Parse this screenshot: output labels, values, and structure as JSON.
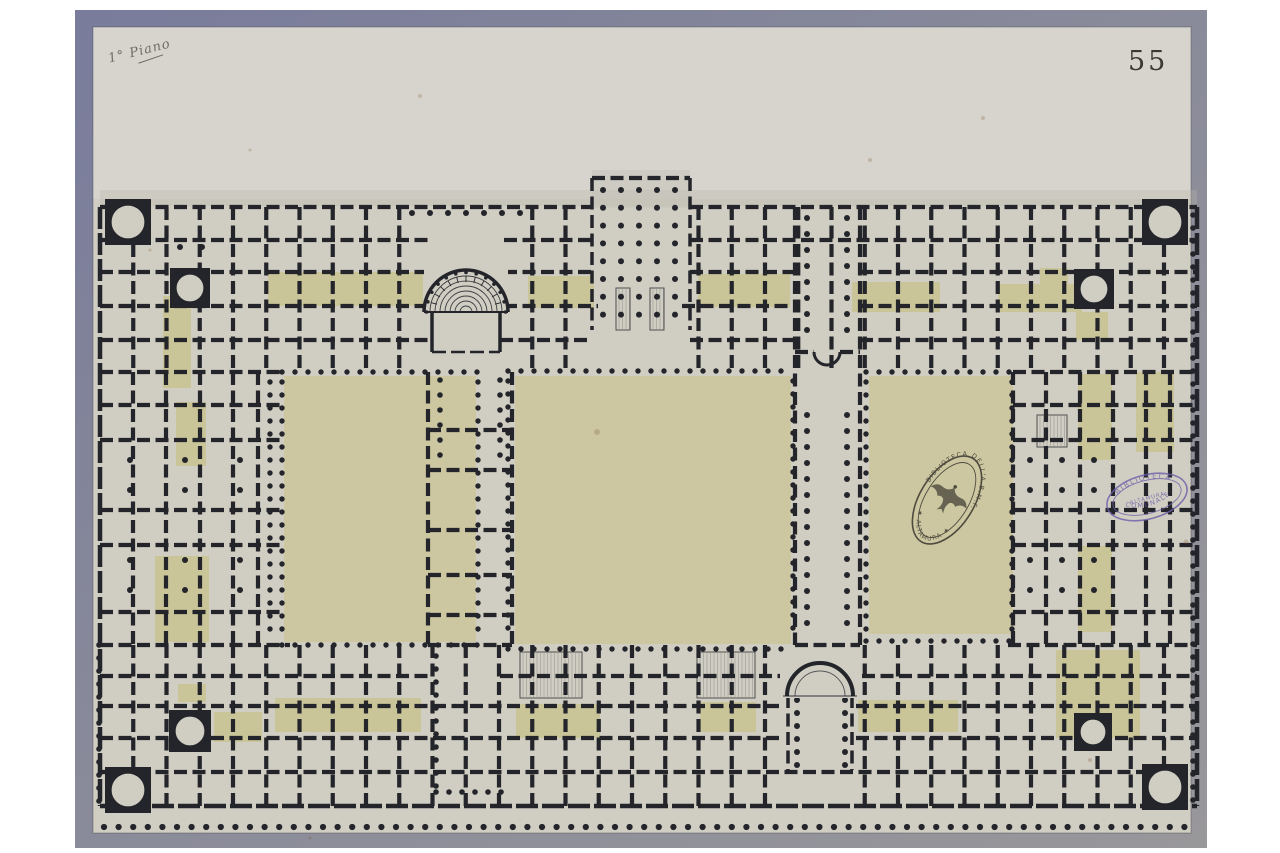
{
  "page": {
    "number": "55",
    "annotation": "1° Piano"
  },
  "stamps": {
    "ink_oval": {
      "top_text": "BIBLIOTECA DELL'A.B.M.F.",
      "bottom_text": "★ ALTAMURA ★",
      "emblem": "eagle"
    },
    "violet_oval": {
      "top_text": "BIBLIOTECA",
      "middle_text": "ALTAMURA",
      "bottom_text": "COMUNALE"
    }
  },
  "colors": {
    "mount_frame_dark": "#797c9b",
    "mount_frame_mid": "#8a8b9a",
    "mount_frame_light": "#98979a",
    "paper": "#d0cdc2",
    "paper_top_band": "#d6d4cc",
    "ink": "#23252b",
    "wash_tint": "#c8c38d",
    "courtyard_fill": "#cbc79c",
    "stamp_ink": "#332f2a",
    "stamp_violet": "#6c5ea9",
    "foxing": "#7a5635"
  }
}
